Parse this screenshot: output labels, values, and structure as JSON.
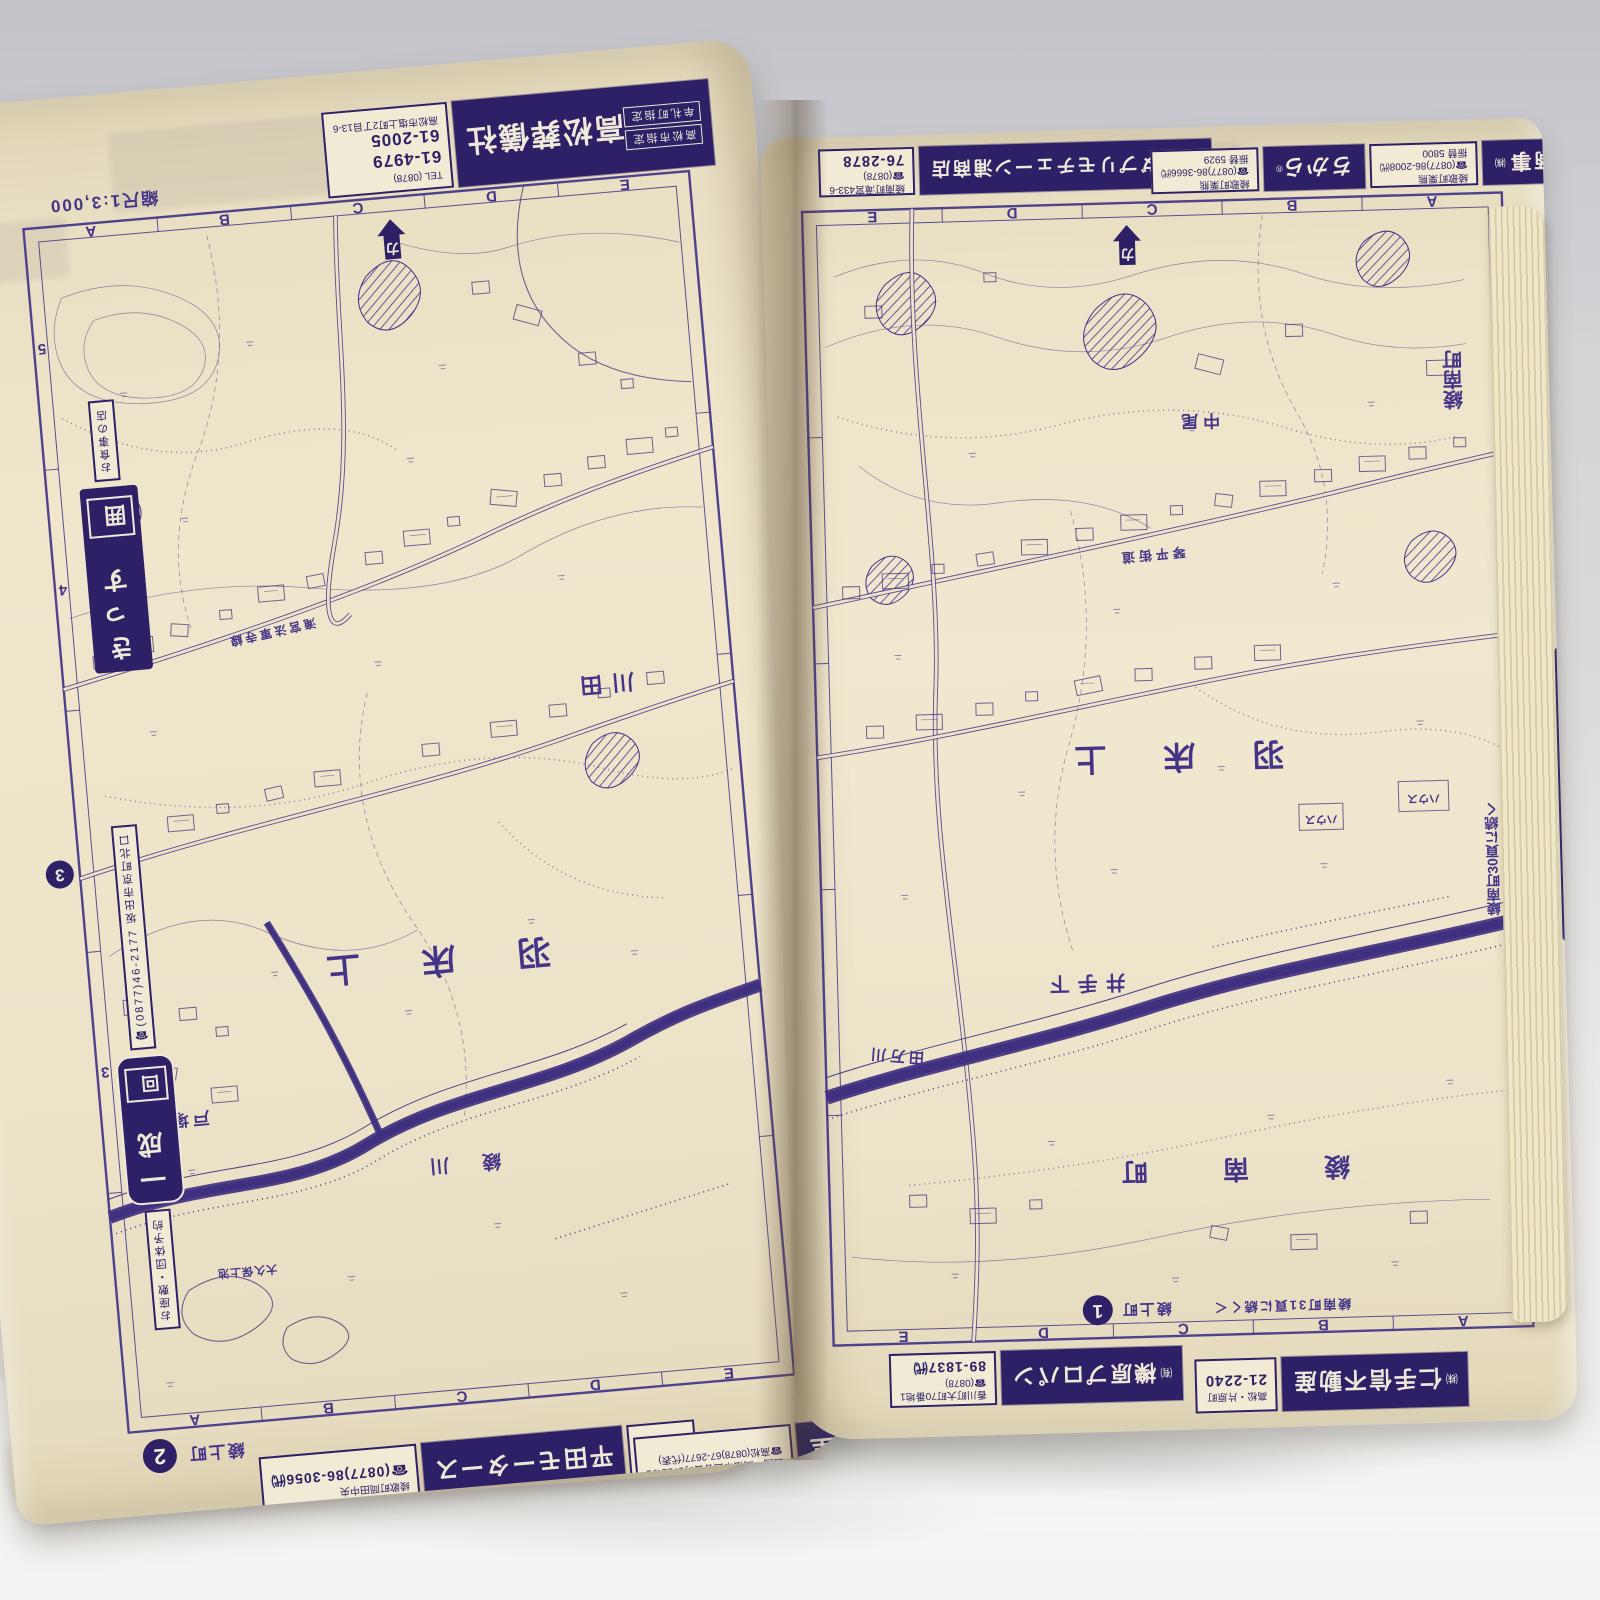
{
  "photo": {
    "ink_color": "#443488",
    "ad_background": "#2d2066",
    "paper_color": "#ece3c9"
  },
  "left_page": {
    "scale_label": "縮尺1:3,000",
    "page_number": "2",
    "page_area_label": "綾上町",
    "grid_top": [
      "A",
      "B",
      "C",
      "D",
      "E"
    ],
    "grid_bottom": [
      "A",
      "B",
      "C",
      "D",
      "E"
    ],
    "grid_side": [
      "5",
      "4",
      "3"
    ],
    "north_arrow_char": "カ",
    "continuation_badge": "3",
    "labels": {
      "area_big": "羽 床 上",
      "kawata": "川田",
      "tozuka": "戸塚",
      "river": "綾  川",
      "road": "滝宮法軍寺線",
      "pond": "大久保上池"
    },
    "ads": {
      "sogisha": {
        "tag1": "高松市指定",
        "tag2": "牟礼町指定",
        "name": "高松葬儀社",
        "tel_label": "TEL (0878)",
        "tel1": "61-4979",
        "tel2": "61-2005",
        "address": "高松市塩上町2丁目13-6"
      },
      "kissu": {
        "small": "お食事の店",
        "logo": "囲",
        "name": "きっす"
      },
      "issei": {
        "tel": "☎(0877)46-2177",
        "address": "坂出市京町北口",
        "name": "一成",
        "logo": "回",
        "note": "お座敷・団体予約"
      },
      "hirata": {
        "name": "平田モータース",
        "tag1": "民間車検",
        "tag2": "代行店",
        "address": "綾歌町岡田中央",
        "tel": "☎(0877)86-3056㈹"
      },
      "bukkodo": {
        "name": "仏光堂",
        "address": "四国・高松市西春日町1721の1",
        "tel": "☎高松(0878)67-2677(代表)"
      }
    }
  },
  "right_page": {
    "page_number": "1",
    "page_area_label": "綾上町",
    "grid_top": [
      "E",
      "D",
      "C",
      "B",
      "A"
    ],
    "grid_bottom": [
      "E",
      "D",
      "C",
      "B",
      "A"
    ],
    "grid_side": [
      "4",
      "3",
      "2"
    ],
    "north_arrow_char": "カ",
    "labels": {
      "area_big": "羽 床 上",
      "ayanami_vertical": "綾南町",
      "ide_shimo": "井手下",
      "nakao": "中尾",
      "ayanami_spaced": "綾 南 町",
      "river": "田万川",
      "house": "ハウス",
      "road": "琴平街道",
      "edge_note": "綾南町30頁に続く",
      "bottom_note": "綾南町31頁に続く＜"
    },
    "ads": {
      "honda": {
        "name": "ホンダプリモチェーン浦商店",
        "address": "綾南町滝宮433-6",
        "tel_label": "☎(0878)",
        "tel": "76-2878"
      },
      "chikara": {
        "name": "ちから",
        "reg": "®",
        "left_address": "綾歌町栗熊",
        "left_tel": "☎(0877)86-3666㈹",
        "left_furikae": "振替 5929",
        "right_address": "綾歌町栗熊",
        "right_tel": "☎(0877)86-2008㈹",
        "right_furikae": "振替 5800"
      },
      "shuto": {
        "name": "首藤商事",
        "kabu": "㈱"
      },
      "kasei": {
        "logo": "四",
        "name": "花勢",
        "address": "高松市今新町",
        "tel": "☎(0878)(51)7635"
      },
      "fudosan": {
        "kabu": "㈱",
        "name": "仁手信不動産",
        "address": "高松・片原町",
        "tel": "21-2240"
      },
      "propane": {
        "yu": "㈲",
        "name": "櫟原プロパン",
        "address": "香川町大町70番地1",
        "tel_label": "☎(0878)",
        "tel": "89-1837㈹"
      }
    }
  }
}
